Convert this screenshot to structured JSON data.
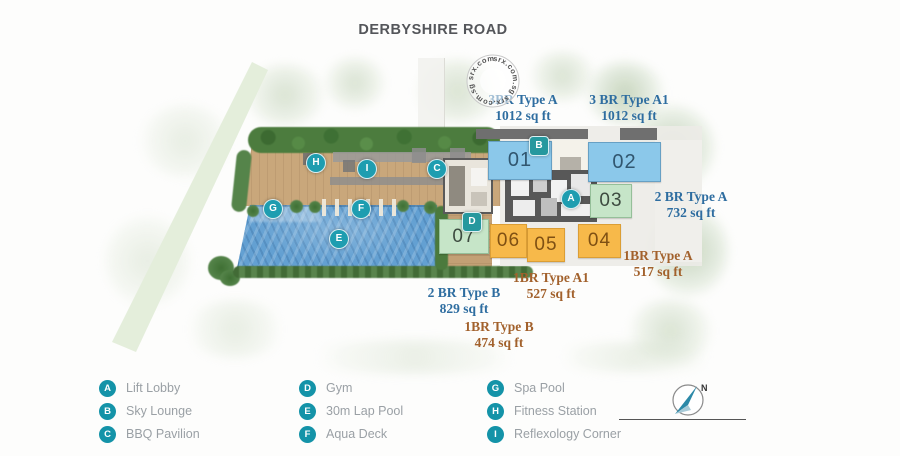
{
  "title": "DERBYSHIRE ROAD",
  "watermark": {
    "ring_text": "srx.com.sg  srx.com.sg  srx.com.sg"
  },
  "plan": {
    "units": [
      {
        "number": "01"
      },
      {
        "number": "02"
      },
      {
        "number": "03"
      },
      {
        "number": "04"
      },
      {
        "number": "05"
      },
      {
        "number": "06"
      },
      {
        "number": "07"
      }
    ],
    "type_labels": [
      {
        "name": "3BR Type A",
        "area": "1012 sq ft"
      },
      {
        "name": "3 BR Type A1",
        "area": "1012 sq ft"
      },
      {
        "name": "2 BR Type A",
        "area": "732 sq ft"
      },
      {
        "name": "1BR Type A",
        "area": "517 sq ft"
      },
      {
        "name": "1BR Type A1",
        "area": "527 sq ft"
      },
      {
        "name": "2 BR Type B",
        "area": "829 sq ft"
      },
      {
        "name": "1BR Type B",
        "area": "474 sq ft"
      }
    ]
  },
  "legend": {
    "items": [
      {
        "letter": "A",
        "label": "Lift Lobby"
      },
      {
        "letter": "B",
        "label": "Sky Lounge"
      },
      {
        "letter": "C",
        "label": "BBQ Pavilion"
      },
      {
        "letter": "D",
        "label": "Gym"
      },
      {
        "letter": "E",
        "label": "30m Lap Pool"
      },
      {
        "letter": "F",
        "label": "Aqua Deck"
      },
      {
        "letter": "G",
        "label": "Spa Pool"
      },
      {
        "letter": "H",
        "label": "Fitness Station"
      },
      {
        "letter": "I",
        "label": "Reflexology Corner"
      }
    ]
  },
  "compass": {
    "north_label": "N"
  },
  "colors": {
    "badge_teal": "#1e9db0",
    "unit_blue": "#8bc8ea",
    "unit_green": "#c6e5c8",
    "unit_orange": "#f7b94a",
    "pool_blue": "#63a0d2",
    "label_blue": "#2e6da0",
    "label_brown": "#a2612c"
  }
}
